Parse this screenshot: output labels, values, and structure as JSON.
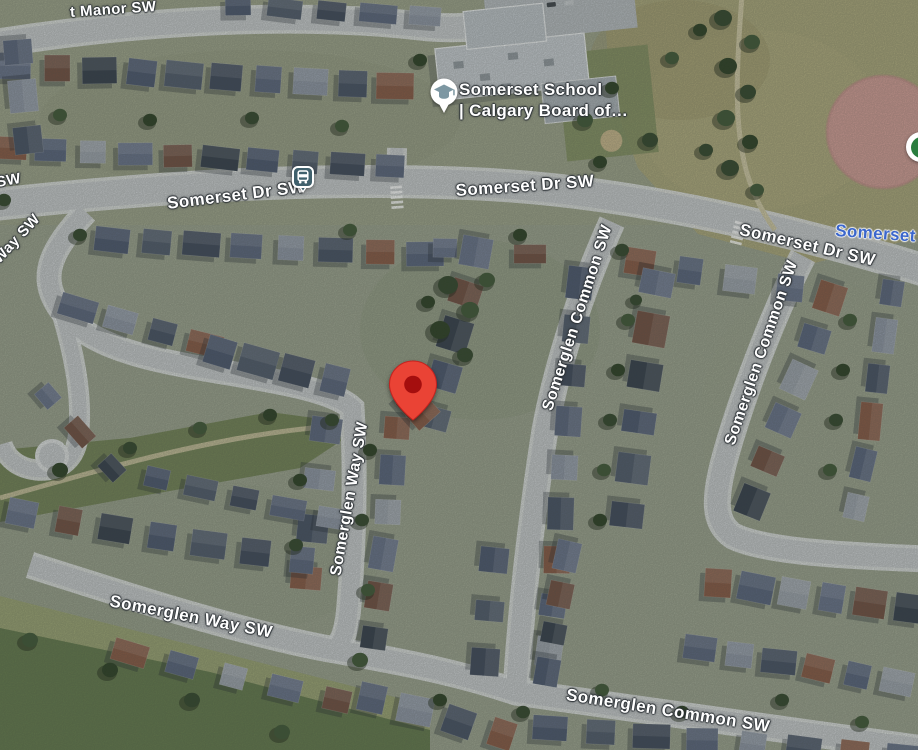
{
  "map": {
    "street_labels": {
      "manor_fragment": "t Manor SW",
      "sw_fragment": "SW",
      "way_sw_fragment": "Way SW",
      "somerset_dr_west": "Somerset Dr SW",
      "somerset_dr_center": "Somerset Dr SW",
      "somerset_dr_east": "Somerset Dr SW",
      "somerglen_common_center": "Somerglen Common SW",
      "somerglen_common_east": "Somerglen Common SW",
      "somerglen_common_south": "Somerglen Common SW",
      "somerglen_way_center": "Somerglen Way SW",
      "somerglen_way_south": "Somerglen Way SW"
    },
    "area_labels": {
      "neighborhood": "Somerset"
    },
    "pois": {
      "school": {
        "name_line1": "Somerset School",
        "name_line2": "| Calgary Board of…",
        "icon": "graduation-cap-icon"
      },
      "transit_stop": {
        "icon": "bus-icon"
      },
      "park": {
        "icon": "park-icon"
      },
      "dropped_pin": {
        "icon": "map-pin-icon"
      }
    },
    "colors": {
      "pin_red": "#EA4335",
      "pin_inner_red": "#A50E0E",
      "neighborhood_label_blue": "#3B66CC",
      "school_icon_gray": "#7D97A2",
      "transit_icon_teal": "#40606C",
      "park_icon_green": "#2A7D3E",
      "road_gray": "#C7CACD",
      "baseball_clay_pink": "#D09A93"
    }
  }
}
